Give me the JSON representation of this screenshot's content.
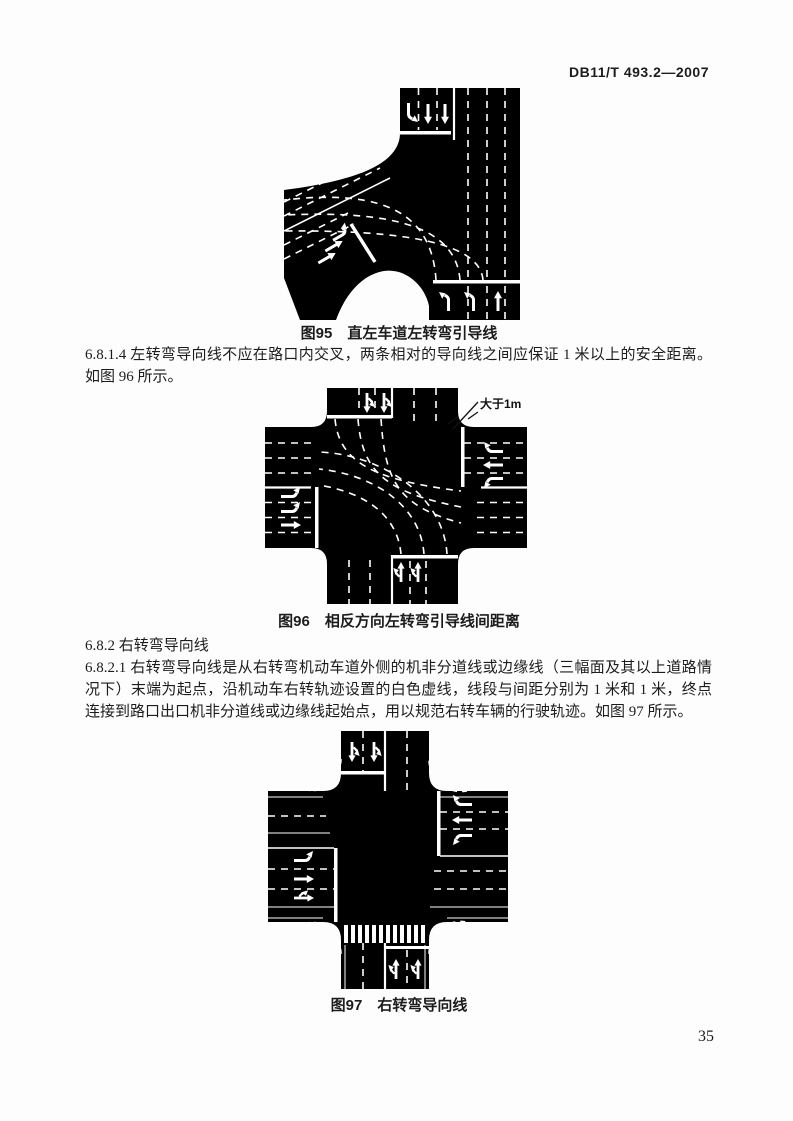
{
  "header": {
    "doc_number": "DB11/T 493.2—2007"
  },
  "sections": {
    "p_6_8_1_4": "6.8.1.4 左转弯导向线不应在路口内交叉，两条相对的导向线之间应保证 1 米以上的安全距离。如图 96 所示。",
    "h_6_8_2": "6.8.2 右转弯导向线",
    "p_6_8_2_1": "6.8.2.1 右转弯导向线是从右转弯机动车道外侧的机非分道线或边缘线（三幅面及其以上道路情况下）末端为起点，沿机动车右转轨迹设置的白色虚线，线段与间距分别为 1 米和 1 米，终点连接到路口出口机非分道线或边缘线起始点，用以规范右转车辆的行驶轨迹。如图 97 所示。"
  },
  "figures": {
    "fig95": {
      "caption": "图95　直左车道左转弯引导线"
    },
    "fig96": {
      "caption": "图96　相反方向左转弯引导线间距离",
      "annotation": "大于1m"
    },
    "fig97": {
      "caption": "图97　右转弯导向线"
    }
  },
  "footer": {
    "page_number": "35"
  },
  "colors": {
    "road": "#000000",
    "marking": "#ffffff",
    "paper": "#fdfdfd"
  }
}
